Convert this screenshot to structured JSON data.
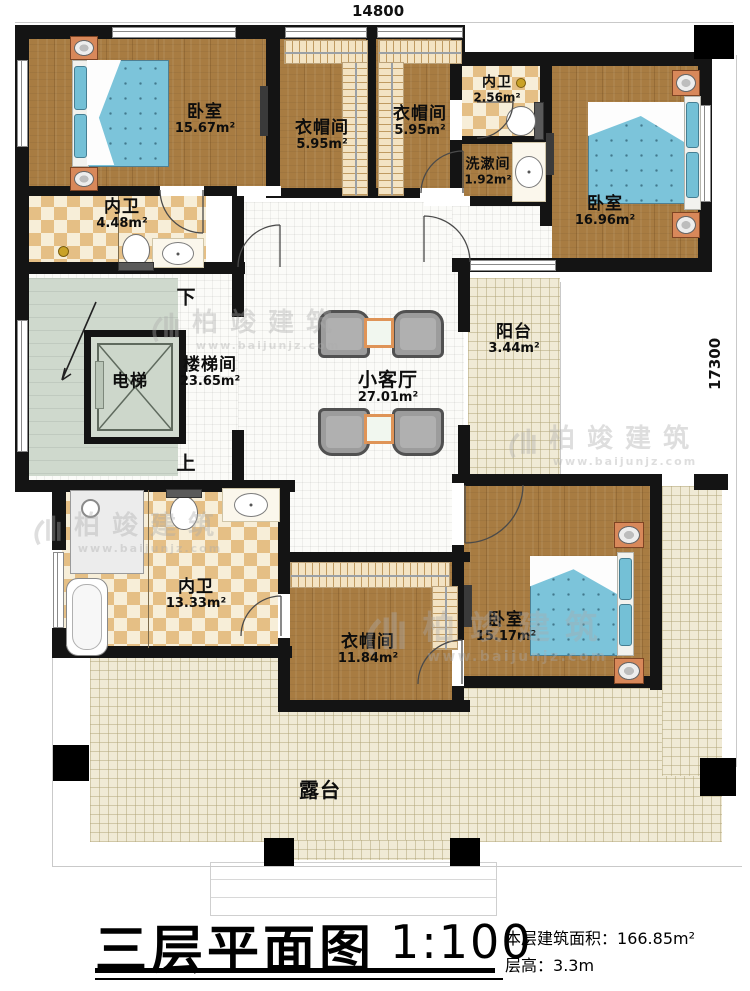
{
  "dimensions": {
    "top": "14800",
    "right": "17300"
  },
  "rooms": {
    "bedroom_tl": {
      "name": "卧室",
      "area": "15.67m²"
    },
    "cloak_1": {
      "name": "衣帽间",
      "area": "5.95m²"
    },
    "cloak_2": {
      "name": "衣帽间",
      "area": "5.95m²"
    },
    "bath_top": {
      "name": "内卫",
      "area": "2.56m²"
    },
    "wash": {
      "name": "洗漱间",
      "area": "1.92m²"
    },
    "bedroom_tr": {
      "name": "卧室",
      "area": "16.96m²"
    },
    "bath_tl": {
      "name": "内卫",
      "area": "4.48m²"
    },
    "elevator": {
      "name": "电梯"
    },
    "stairwell": {
      "name": "楼梯间",
      "area": "23.65m²"
    },
    "living": {
      "name": "小客厅",
      "area": "27.01m²"
    },
    "balcony": {
      "name": "阳台",
      "area": "3.44m²"
    },
    "bath_bl": {
      "name": "内卫",
      "area": "13.33m²"
    },
    "cloak_3": {
      "name": "衣帽间",
      "area": "11.84m²"
    },
    "bedroom_br": {
      "name": "卧室",
      "area": "15.17m²"
    },
    "terrace": {
      "name": "露台"
    }
  },
  "stairs": {
    "down": "下",
    "up": "上"
  },
  "titleblock": {
    "title": "三层平面图",
    "scale": "1:100",
    "area_label": "本层建筑面积：",
    "area_value": "166.85m²",
    "height_label": "层高：",
    "height_value": "3.3m"
  },
  "watermark": {
    "name": "柏竣建筑",
    "url": "www.baijunjz.com"
  },
  "colors": {
    "wall": "#141414",
    "wood": "#a87c42",
    "tile_dark": "#e5bf85",
    "tile_light": "#f7eed8",
    "stair": "#cfd9cd",
    "terrace": "#f0ead5",
    "bed": "#7cc4da",
    "copper": "#d8885a"
  }
}
